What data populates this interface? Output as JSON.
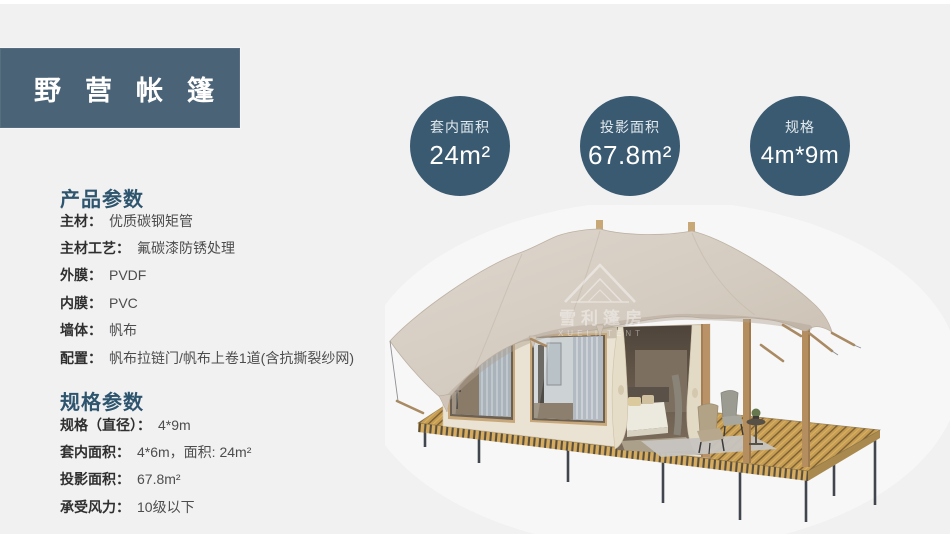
{
  "header": {
    "title": "野营帐篷"
  },
  "badges": [
    {
      "label": "套内面积",
      "value": "24m²"
    },
    {
      "label": "投影面积",
      "value": "67.8m²"
    },
    {
      "label": "规格",
      "value": "4m*9m"
    }
  ],
  "product_params": {
    "title": "产品参数",
    "rows": [
      {
        "label": "主材：",
        "value": "优质碳钢矩管"
      },
      {
        "label": "主材工艺：",
        "value": "氟碳漆防锈处理"
      },
      {
        "label": "外膜：",
        "value": "PVDF"
      },
      {
        "label": "内膜：",
        "value": "PVC"
      },
      {
        "label": "墙体：",
        "value": "帆布"
      },
      {
        "label": "配置：",
        "value": "帆布拉链门/帆布上卷1道(含抗撕裂纱网)"
      }
    ]
  },
  "spec_params": {
    "title": "规格参数",
    "rows": [
      {
        "label": "规格（直径）：",
        "value": "4*9m"
      },
      {
        "label": "套内面积：",
        "value": "4*6m，面积: 24m²"
      },
      {
        "label": "投影面积：",
        "value": "67.8m²"
      },
      {
        "label": "承受风力：",
        "value": "10级以下"
      }
    ]
  },
  "watermark": {
    "cjk": "雪利篷房",
    "en": "XUELI TENT"
  },
  "colors": {
    "page_bg": "#f1f1f2",
    "header_bg": "#4b6377",
    "badge_bg": "#3a5a71",
    "section_title": "#2e556e",
    "canvas_roof": "#d5ccc1",
    "deck_wood": "#c79d52"
  }
}
